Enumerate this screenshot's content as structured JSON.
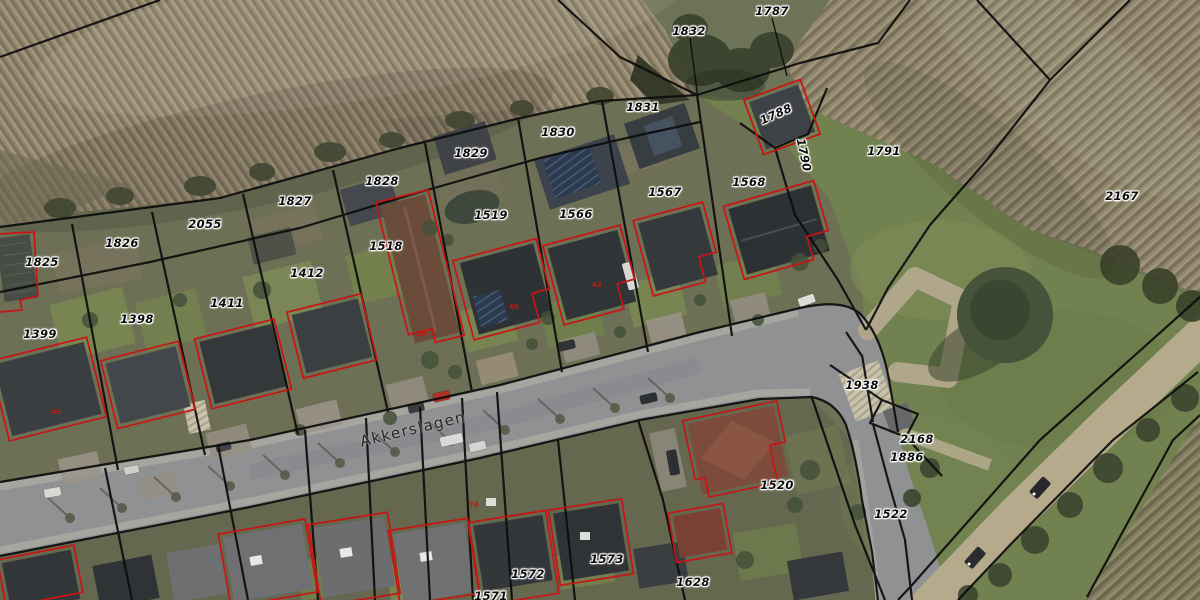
{
  "map": {
    "type": "aerial-cadastral-map",
    "street_label": {
      "text": "Akkerslagen",
      "x": 413,
      "y": 429,
      "rot": -13.5
    },
    "colors": {
      "parcel_line": "#0c0c0c",
      "building_outline": "#c81414",
      "label_text": "#0b0b0b",
      "label_halo": "#ffffff",
      "house_number": "#c2180c"
    },
    "parcel_labels": [
      {
        "text": "1787",
        "x": 772,
        "y": 11,
        "rot": 0
      },
      {
        "text": "1832",
        "x": 689,
        "y": 31,
        "rot": 0
      },
      {
        "text": "1831",
        "x": 643,
        "y": 107,
        "rot": 0
      },
      {
        "text": "1830",
        "x": 558,
        "y": 132,
        "rot": 0
      },
      {
        "text": "1829",
        "x": 471,
        "y": 153,
        "rot": 0
      },
      {
        "text": "1828",
        "x": 382,
        "y": 181,
        "rot": 0
      },
      {
        "text": "1827",
        "x": 295,
        "y": 201,
        "rot": 0
      },
      {
        "text": "2055",
        "x": 205,
        "y": 224,
        "rot": 0
      },
      {
        "text": "1826",
        "x": 122,
        "y": 243,
        "rot": 0
      },
      {
        "text": "1825",
        "x": 42,
        "y": 262,
        "rot": 0
      },
      {
        "text": "1518",
        "x": 386,
        "y": 246,
        "rot": 0
      },
      {
        "text": "1519",
        "x": 491,
        "y": 215,
        "rot": 0
      },
      {
        "text": "1566",
        "x": 576,
        "y": 214,
        "rot": 0
      },
      {
        "text": "1567",
        "x": 665,
        "y": 192,
        "rot": 0
      },
      {
        "text": "1568",
        "x": 749,
        "y": 182,
        "rot": 0
      },
      {
        "text": "1788",
        "x": 776,
        "y": 114,
        "rot": -24
      },
      {
        "text": "1790",
        "x": 804,
        "y": 155,
        "rot": 78
      },
      {
        "text": "1791",
        "x": 884,
        "y": 151,
        "rot": 0
      },
      {
        "text": "2167",
        "x": 1122,
        "y": 196,
        "rot": 0
      },
      {
        "text": "1412",
        "x": 307,
        "y": 273,
        "rot": 0
      },
      {
        "text": "1411",
        "x": 227,
        "y": 303,
        "rot": 0
      },
      {
        "text": "1398",
        "x": 137,
        "y": 319,
        "rot": 0
      },
      {
        "text": "1399",
        "x": 40,
        "y": 334,
        "rot": 0
      },
      {
        "text": "1938",
        "x": 862,
        "y": 385,
        "rot": 0
      },
      {
        "text": "2168",
        "x": 917,
        "y": 439,
        "rot": 0
      },
      {
        "text": "1886",
        "x": 907,
        "y": 457,
        "rot": 0
      },
      {
        "text": "1520",
        "x": 777,
        "y": 485,
        "rot": 0
      },
      {
        "text": "1522",
        "x": 891,
        "y": 514,
        "rot": 0
      },
      {
        "text": "1572",
        "x": 528,
        "y": 574,
        "rot": 0
      },
      {
        "text": "1573",
        "x": 607,
        "y": 559,
        "rot": 0
      },
      {
        "text": "1571",
        "x": 491,
        "y": 596,
        "rot": 0
      },
      {
        "text": "1628",
        "x": 693,
        "y": 582,
        "rot": 0
      }
    ],
    "house_numbers": [
      {
        "text": "38",
        "x": 421,
        "y": 334
      },
      {
        "text": "40",
        "x": 514,
        "y": 307
      },
      {
        "text": "42",
        "x": 597,
        "y": 285
      },
      {
        "text": "49",
        "x": 56,
        "y": 412
      },
      {
        "text": "76",
        "x": 474,
        "y": 505
      }
    ]
  }
}
